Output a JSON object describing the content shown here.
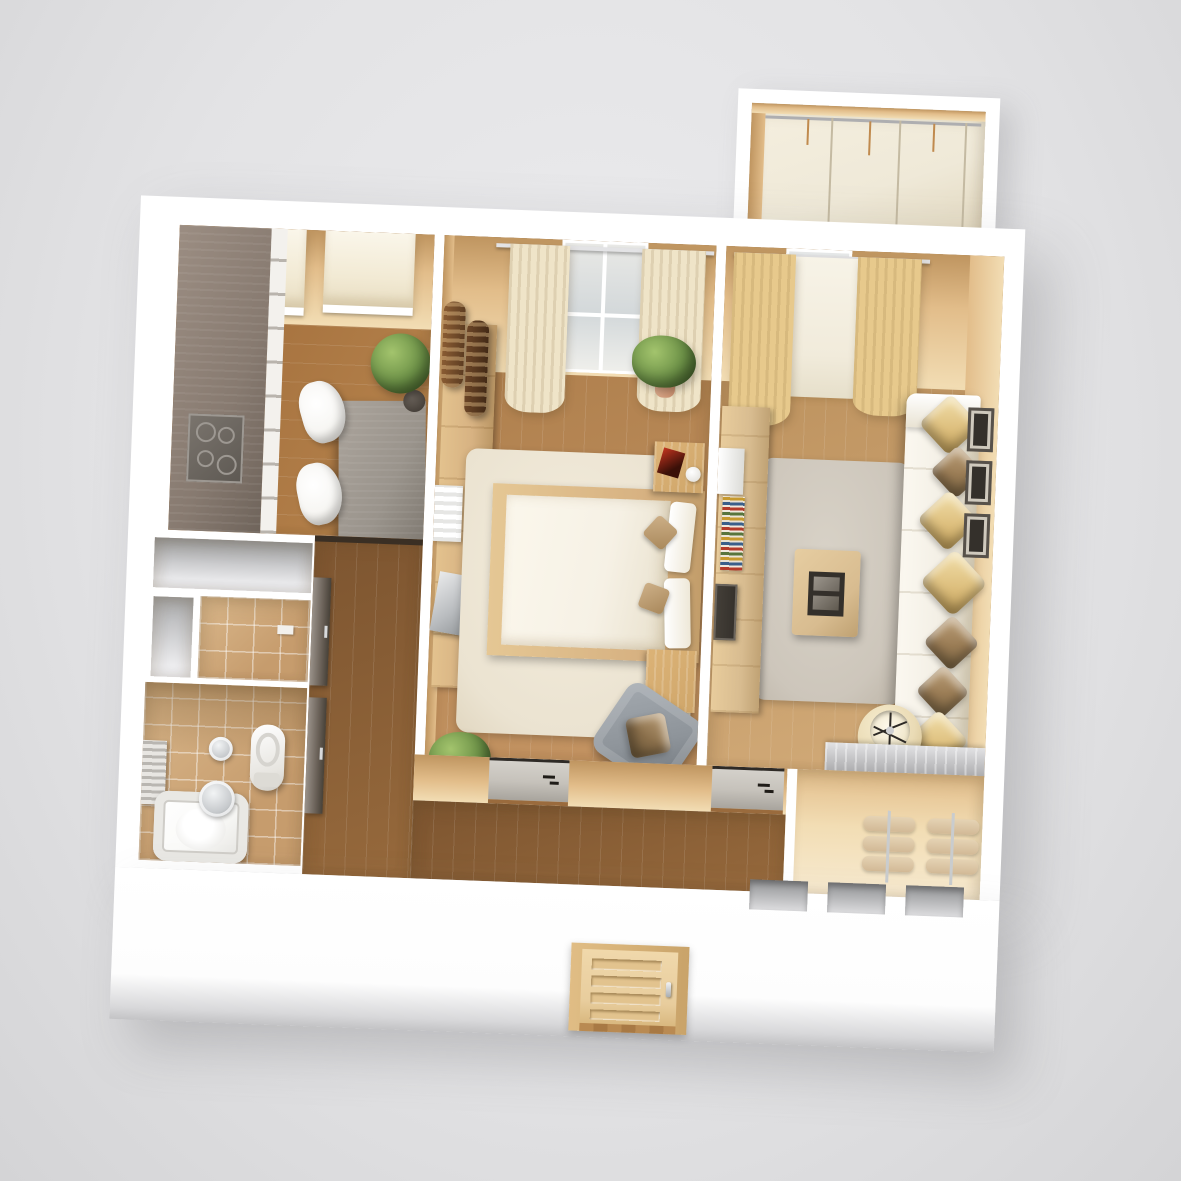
{
  "scene": {
    "type": "3d-floor-plan-render",
    "view": "top-down isometric apartment render on gray backdrop",
    "visible_text": "none"
  },
  "palette": {
    "bg_top": "#ececee",
    "bg_bottom": "#d4d4d6",
    "wall_white": "#ffffff",
    "wall_tan_dark": "#bf9560",
    "wall_tan": "#e2bd8a",
    "wall_tan_light": "#f2ddb4",
    "floor_kitchen_1": "#9e6a38",
    "floor_kitchen_2": "#b8854e",
    "floor_bedroom_1": "#a97a47",
    "floor_bedroom_2": "#c49463",
    "floor_living_1": "#b88c58",
    "floor_living_2": "#d2ab79",
    "floor_hall_1": "#7d5530",
    "floor_hall_2": "#96693c",
    "tile": "#c69c6d",
    "tile_light": "#dab88c",
    "balcony_floor": "#efe9d8",
    "blind": "#f2ead4",
    "curtain_cream": "#efe4c8",
    "curtain_gold": "#e7c98c",
    "sheer": "#f1ebdb",
    "counter": "#877a70",
    "cabinet_front": "#f3f1ed",
    "table": "#9a948c",
    "chair": "#f7f6f3",
    "rug_bedroom": "#ebe3d1",
    "rug_living": "#cdc6bb",
    "bed_frame": "#d7b282",
    "mattress": "#f6f1e5",
    "nightstand": "#cfa66a",
    "sofa": "#f3efe5",
    "pillow_gold": "#dec07f",
    "pillow_bronze": "#9a7c55",
    "lamp": "#eadbb5",
    "coffee_table": "#d8bc90",
    "dark": "#34302b",
    "plant": "#6b9046",
    "plant_dark": "#49682e",
    "pot": "#3a342e",
    "terracotta": "#c98f6e",
    "tub": "#fafaf8",
    "chrome": "#c6c9cc",
    "entry_door": "#e8cd9d",
    "entry_frame": "#d6b177",
    "interior_door": "#c6c2bb",
    "dark_door": "#6a6158",
    "towel": "#d2b996",
    "niche": "#a7a8aa",
    "armchair": "#8e949a"
  },
  "apartment": {
    "rooms": [
      {
        "name": "balcony",
        "position": "top-right, projecting outward",
        "features": [
          "glazed window wall",
          "cream floor"
        ]
      },
      {
        "name": "kitchen",
        "position": "top-left",
        "features": [
          "L-shaped counter",
          "cooktop",
          "white cabinet fronts",
          "dining table",
          "2 white chairs",
          "2 roman blinds",
          "topiary plant"
        ]
      },
      {
        "name": "bedroom",
        "position": "top-center",
        "features": [
          "double bed",
          "2 nightstands",
          "red book",
          "white mug",
          "wall dresser",
          "radiator",
          "gray armchair with bronze pillow",
          "2 potted plants",
          "2 brown vases",
          "cream curtains with window",
          "cream rug"
        ]
      },
      {
        "name": "living-room",
        "position": "top-right",
        "features": [
          "white corner sofa",
          "7 satin pillows",
          "coffee table with tray",
          "drum floor lamp",
          "tv stand with books and tv",
          "3 wall pictures",
          "gold curtains with sheer",
          "gray rug",
          "silver media bench"
        ]
      },
      {
        "name": "storage-niche",
        "position": "mid-left",
        "features": [
          "empty white niche",
          "narrow white niche"
        ]
      },
      {
        "name": "wc",
        "position": "mid-left",
        "features": [
          "tan tiled floor"
        ]
      },
      {
        "name": "bathroom",
        "position": "bottom-left",
        "features": [
          "bathtub",
          "toilet",
          "glass stool",
          "towel rail",
          "tan tiles"
        ]
      },
      {
        "name": "hallway",
        "position": "bottom-center L-shape",
        "features": [
          "dark closet doors",
          "2 gray interior doors",
          "dark wood floor"
        ]
      },
      {
        "name": "closet",
        "position": "bottom-right",
        "features": [
          "2 towel racks with stacked tan towels"
        ]
      },
      {
        "name": "front-wall",
        "position": "bottom",
        "features": [
          "wood entrance door with handle",
          "3 gray wall niches"
        ]
      }
    ]
  }
}
